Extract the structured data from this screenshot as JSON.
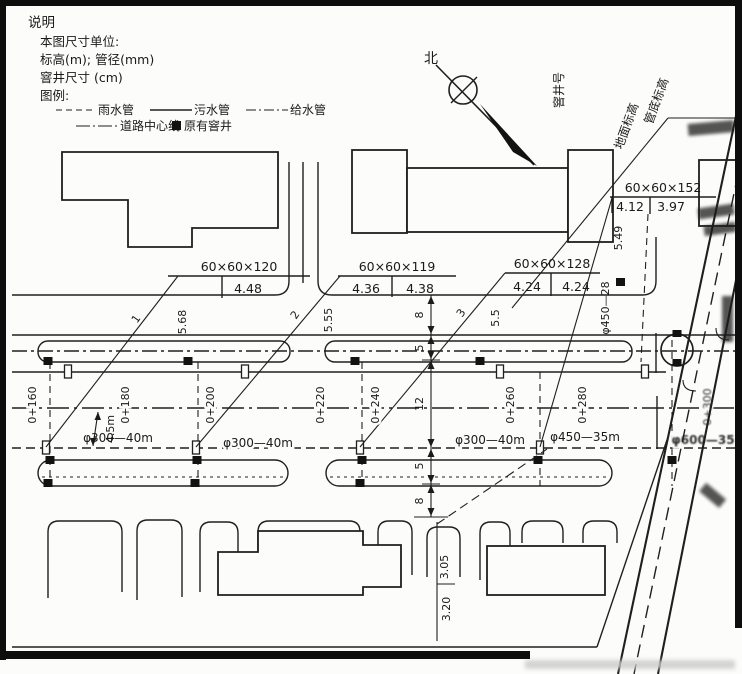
{
  "notes": {
    "heading": "说明",
    "line1": "本图尺寸单位:",
    "line2": "标高(m); 管径(mm)",
    "line3": "窨井尺寸 (cm)",
    "line4": "图例:"
  },
  "legend": {
    "rain": "雨水管",
    "sewage": "污水管",
    "water": "给水管",
    "centerline": "道路中心线",
    "existing_manhole": "原有窨井"
  },
  "compass": {
    "north": "北"
  },
  "callout_key": {
    "manhole_no": "窨井号",
    "ground_elev": "地面标高",
    "invert_elev": "管底标高"
  },
  "callouts": [
    {
      "size": "60×60×120",
      "no": "1",
      "ground": "5.68",
      "invert": "4.48"
    },
    {
      "size": "60×60×119",
      "no": "2",
      "ground": "5.55",
      "invert_left": "4.36",
      "invert_right": "4.38"
    },
    {
      "size": "60×60×128",
      "no": "3",
      "ground": "5.5",
      "invert_left": "4.24",
      "invert_right": "4.24"
    },
    {
      "size": "60×60×152",
      "ground": "5.49",
      "invert_left": "4.12",
      "invert_right": "3.97"
    }
  ],
  "stations": [
    "0+160",
    "0+180",
    "0+200",
    "0+220",
    "0+240",
    "0+260",
    "0+280",
    "0+300"
  ],
  "pipes": {
    "seg1": "φ300—40m",
    "seg2": "φ300—40m",
    "seg3": "φ300—40m",
    "seg4": "φ450—35m",
    "seg5": "φ600—35",
    "branch": "φ450—28"
  },
  "dims": {
    "d1": "8",
    "d2": "5",
    "d3": "12",
    "d4": "5",
    "d5": "8",
    "depth": "4.5m",
    "branch_upper": "3.05",
    "branch_lower": "3.20"
  }
}
